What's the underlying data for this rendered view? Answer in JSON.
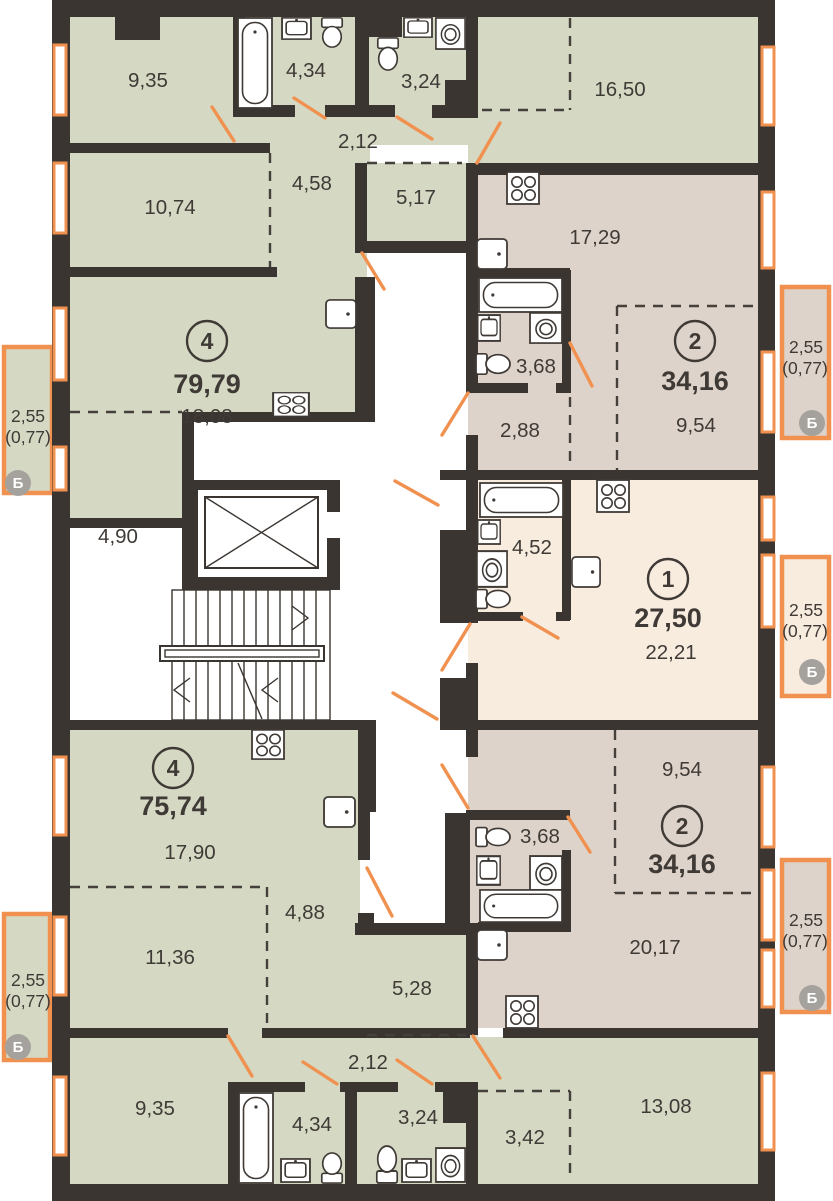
{
  "title": "Floor plan with five apartments",
  "colors": {
    "wall": "#3a3531",
    "apartment4_fill": "#d5d9c3",
    "apartment2_fill": "#ded3ca",
    "apartment1_fill": "#f8ecdf",
    "window_accent": "#f09150",
    "badge_gray": "#a5a29e",
    "text": "#3f3a36"
  },
  "balcony_label": {
    "area": "2,55",
    "reduced": "(0,77)",
    "badge": "Б"
  },
  "apartments": {
    "apt4_top": {
      "number": "4",
      "total": "79,79",
      "rooms": {
        "room1": "9,35",
        "bath": "4,34",
        "wc": "3,24",
        "room3": "16,50",
        "hall": "2,12",
        "corridor": "4,58",
        "storage": "5,17",
        "room2": "10,74",
        "living": "18,08",
        "alcove": "4,90"
      }
    },
    "apt2_top": {
      "number": "2",
      "total": "34,16",
      "rooms": {
        "kitchen_living": "17,29",
        "bath": "3,68",
        "hall": "2,88",
        "sleeping": "9,54"
      }
    },
    "apt1": {
      "number": "1",
      "total": "27,50",
      "rooms": {
        "bath": "4,52",
        "living": "22,21"
      }
    },
    "apt4_bottom": {
      "number": "4",
      "total": "75,74",
      "rooms": {
        "living": "17,90",
        "corridor": "4,88",
        "alcove": "11,36",
        "storage": "5,28",
        "hall": "2,12",
        "room1": "9,35",
        "bath": "4,34",
        "wc": "3,24",
        "room2": "13,08",
        "alcove2": "3,42"
      }
    },
    "apt2_bottom": {
      "number": "2",
      "total": "34,16",
      "rooms": {
        "sleeping": "9,54",
        "bath": "3,68",
        "kitchen_living": "20,17"
      }
    }
  }
}
